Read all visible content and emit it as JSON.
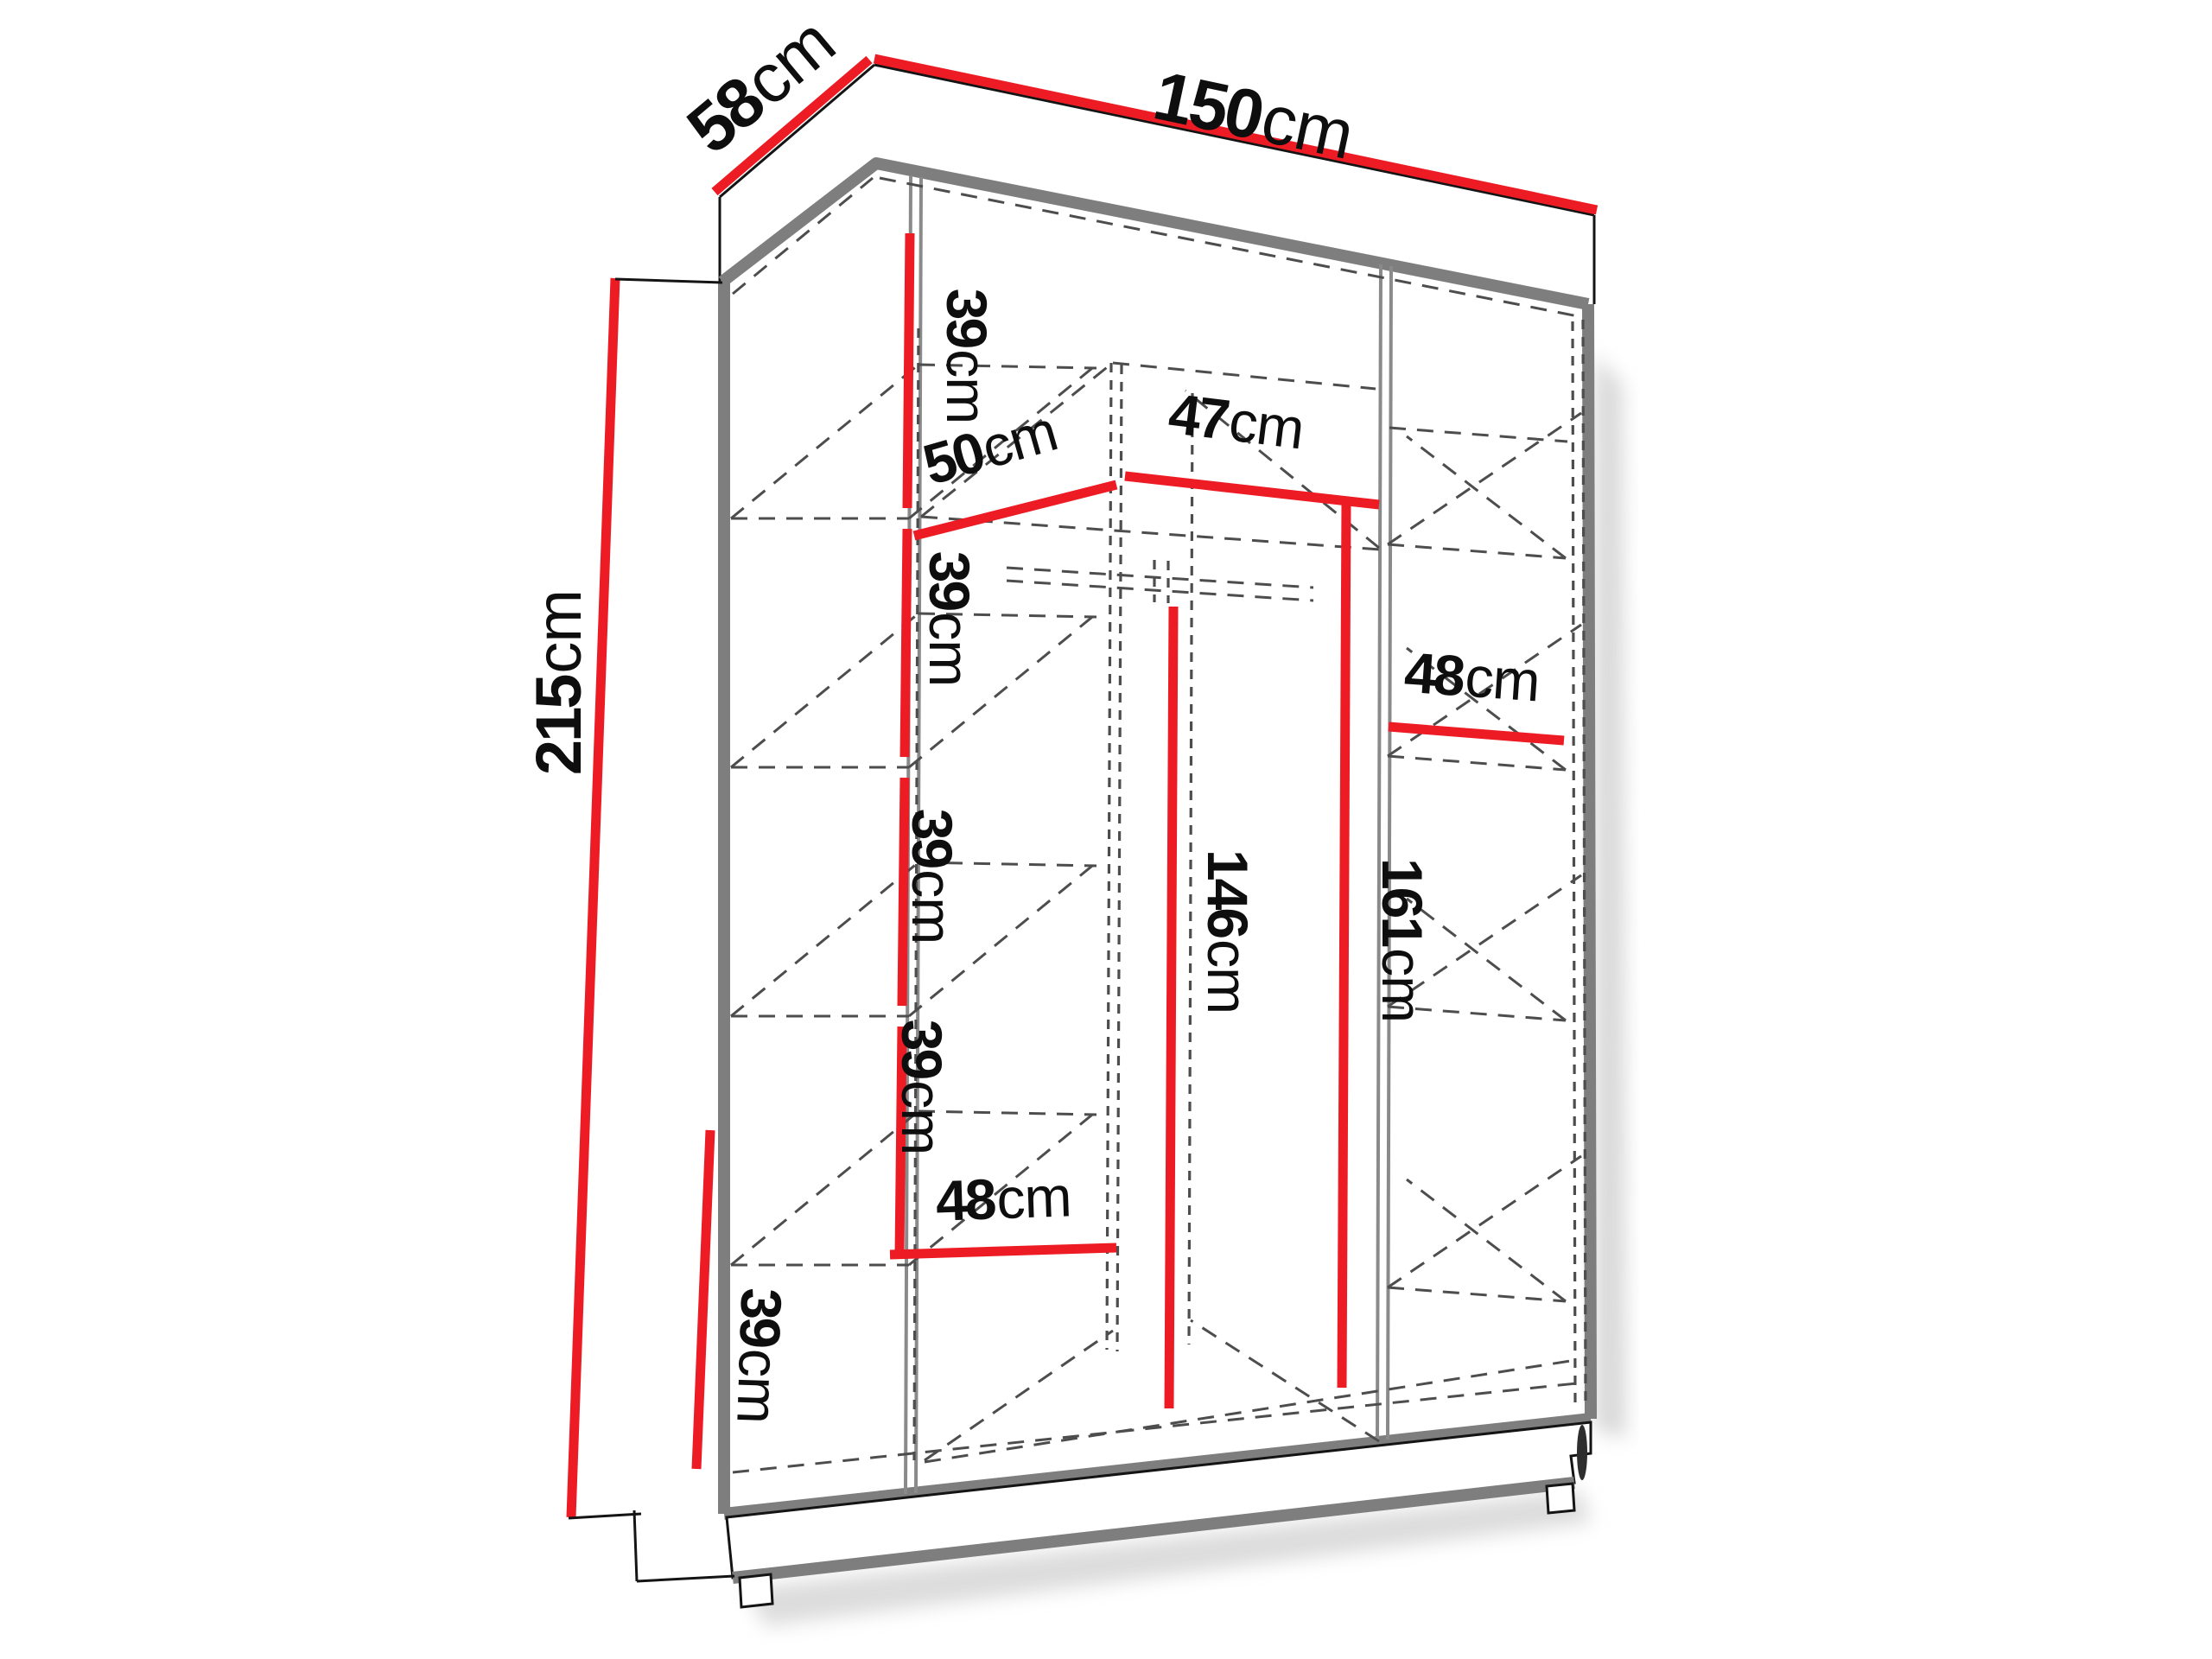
{
  "diagram": {
    "name": "wardrobe-dimension-diagram",
    "subject": "three-section wardrobe interior with shelves and hanging space",
    "unit": "cm",
    "colors": {
      "dimension_line": "#ed1c24",
      "frame_edge": "#7e7e7e",
      "hidden_edge": "#4d4d4d",
      "label_text": "#0e0e0e",
      "background": "#ffffff"
    },
    "dimensions": {
      "width": {
        "value": "150",
        "unit": "cm"
      },
      "depth": {
        "value": "58",
        "unit": "cm"
      },
      "height": {
        "value": "215",
        "unit": "cm"
      },
      "left_shelf_gap_1": {
        "value": "39",
        "unit": "cm"
      },
      "left_shelf_gap_2": {
        "value": "39",
        "unit": "cm"
      },
      "left_shelf_gap_3": {
        "value": "39",
        "unit": "cm"
      },
      "left_shelf_gap_4": {
        "value": "39",
        "unit": "cm"
      },
      "left_section_width": {
        "value": "50",
        "unit": "cm"
      },
      "middle_section_width": {
        "value": "47",
        "unit": "cm"
      },
      "right_shelf_width": {
        "value": "48",
        "unit": "cm"
      },
      "middle_hanging_height": {
        "value": "146",
        "unit": "cm"
      },
      "right_hanging_height": {
        "value": "161",
        "unit": "cm"
      },
      "bottom_section_width": {
        "value": "48",
        "unit": "cm"
      },
      "bottom_left_gap": {
        "value": "39",
        "unit": "cm"
      }
    }
  }
}
